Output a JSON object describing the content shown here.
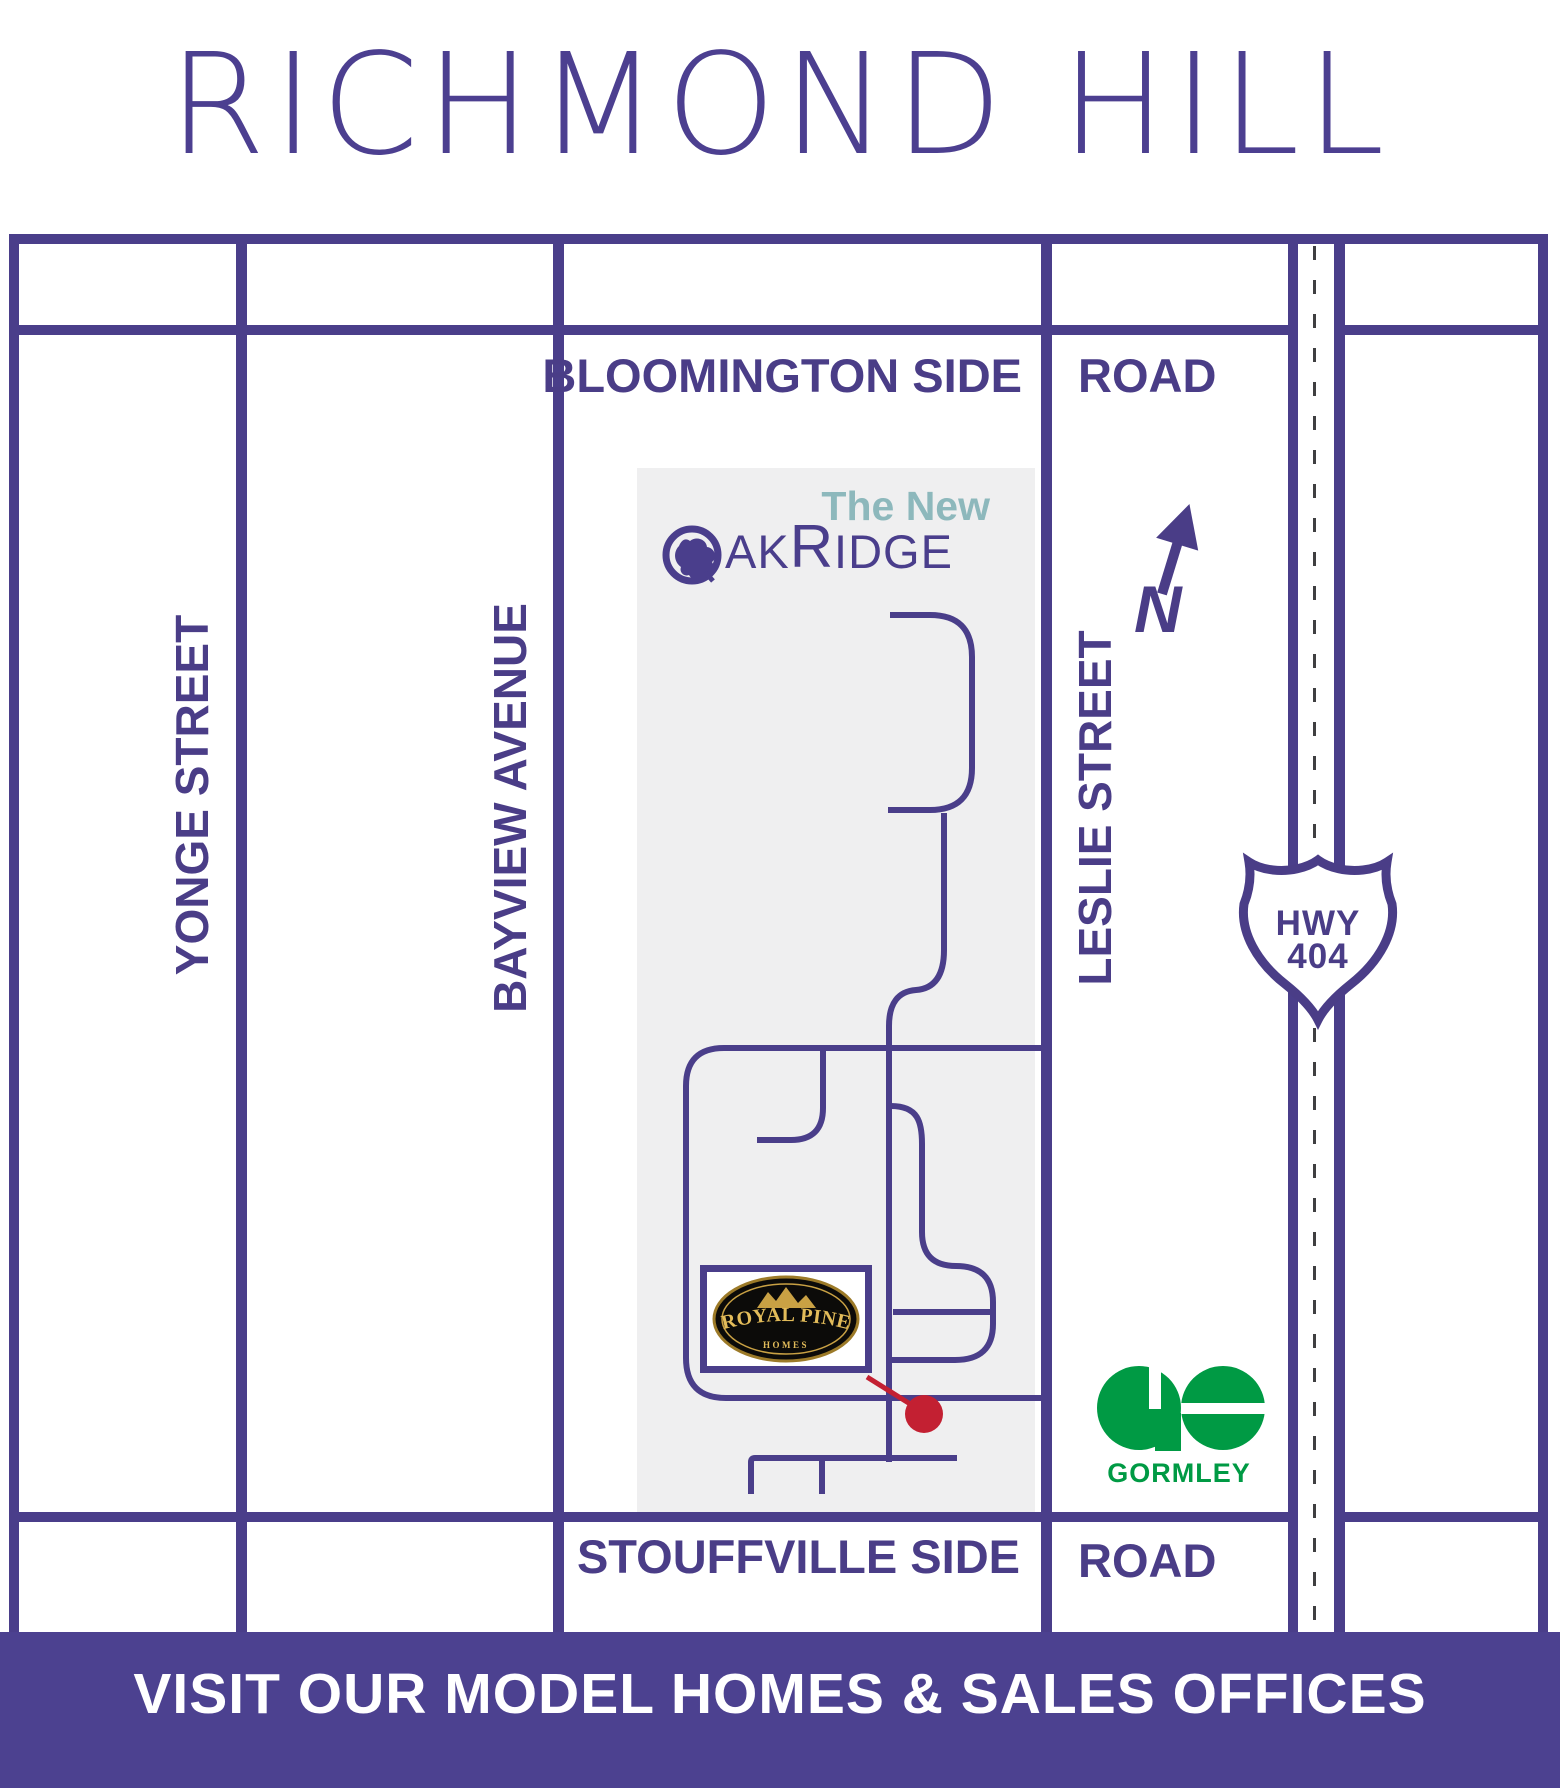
{
  "title": "RICHMOND HILL",
  "streets": {
    "yonge": "YONGE STREET",
    "bayview": "BAYVIEW AVENUE",
    "leslie": "LESLIE STREET",
    "bloomington_main": "BLOOMINGTON SIDE",
    "bloomington_suffix": "ROAD",
    "stouffville_main": "STOUFFVILLE SIDE",
    "stouffville_suffix": "ROAD"
  },
  "highway": {
    "line1": "HWY",
    "line2": "404"
  },
  "compass": {
    "label": "N"
  },
  "development": {
    "tagline": "The New",
    "brand_ak": "AK",
    "brand_r": "R",
    "brand_idge": "IDGE"
  },
  "royal_pine": {
    "name": "ROYAL PINE",
    "sub": "HOMES"
  },
  "go_station": {
    "name": "GORMLEY"
  },
  "banner": {
    "text": "VISIT OUR MODEL HOMES & SALES OFFICES"
  },
  "colors": {
    "road_purple": "#4a3e8a",
    "banner_purple": "#4c4190",
    "title_purple": "#4c3f90",
    "tagline_teal": "#8db8bc",
    "development_grey": "#efeff0",
    "go_green": "#009a44",
    "marker_red": "#c32032",
    "hwy_dash_grey": "#3f3f41",
    "royal_pine_gold": "#d9b04c"
  }
}
